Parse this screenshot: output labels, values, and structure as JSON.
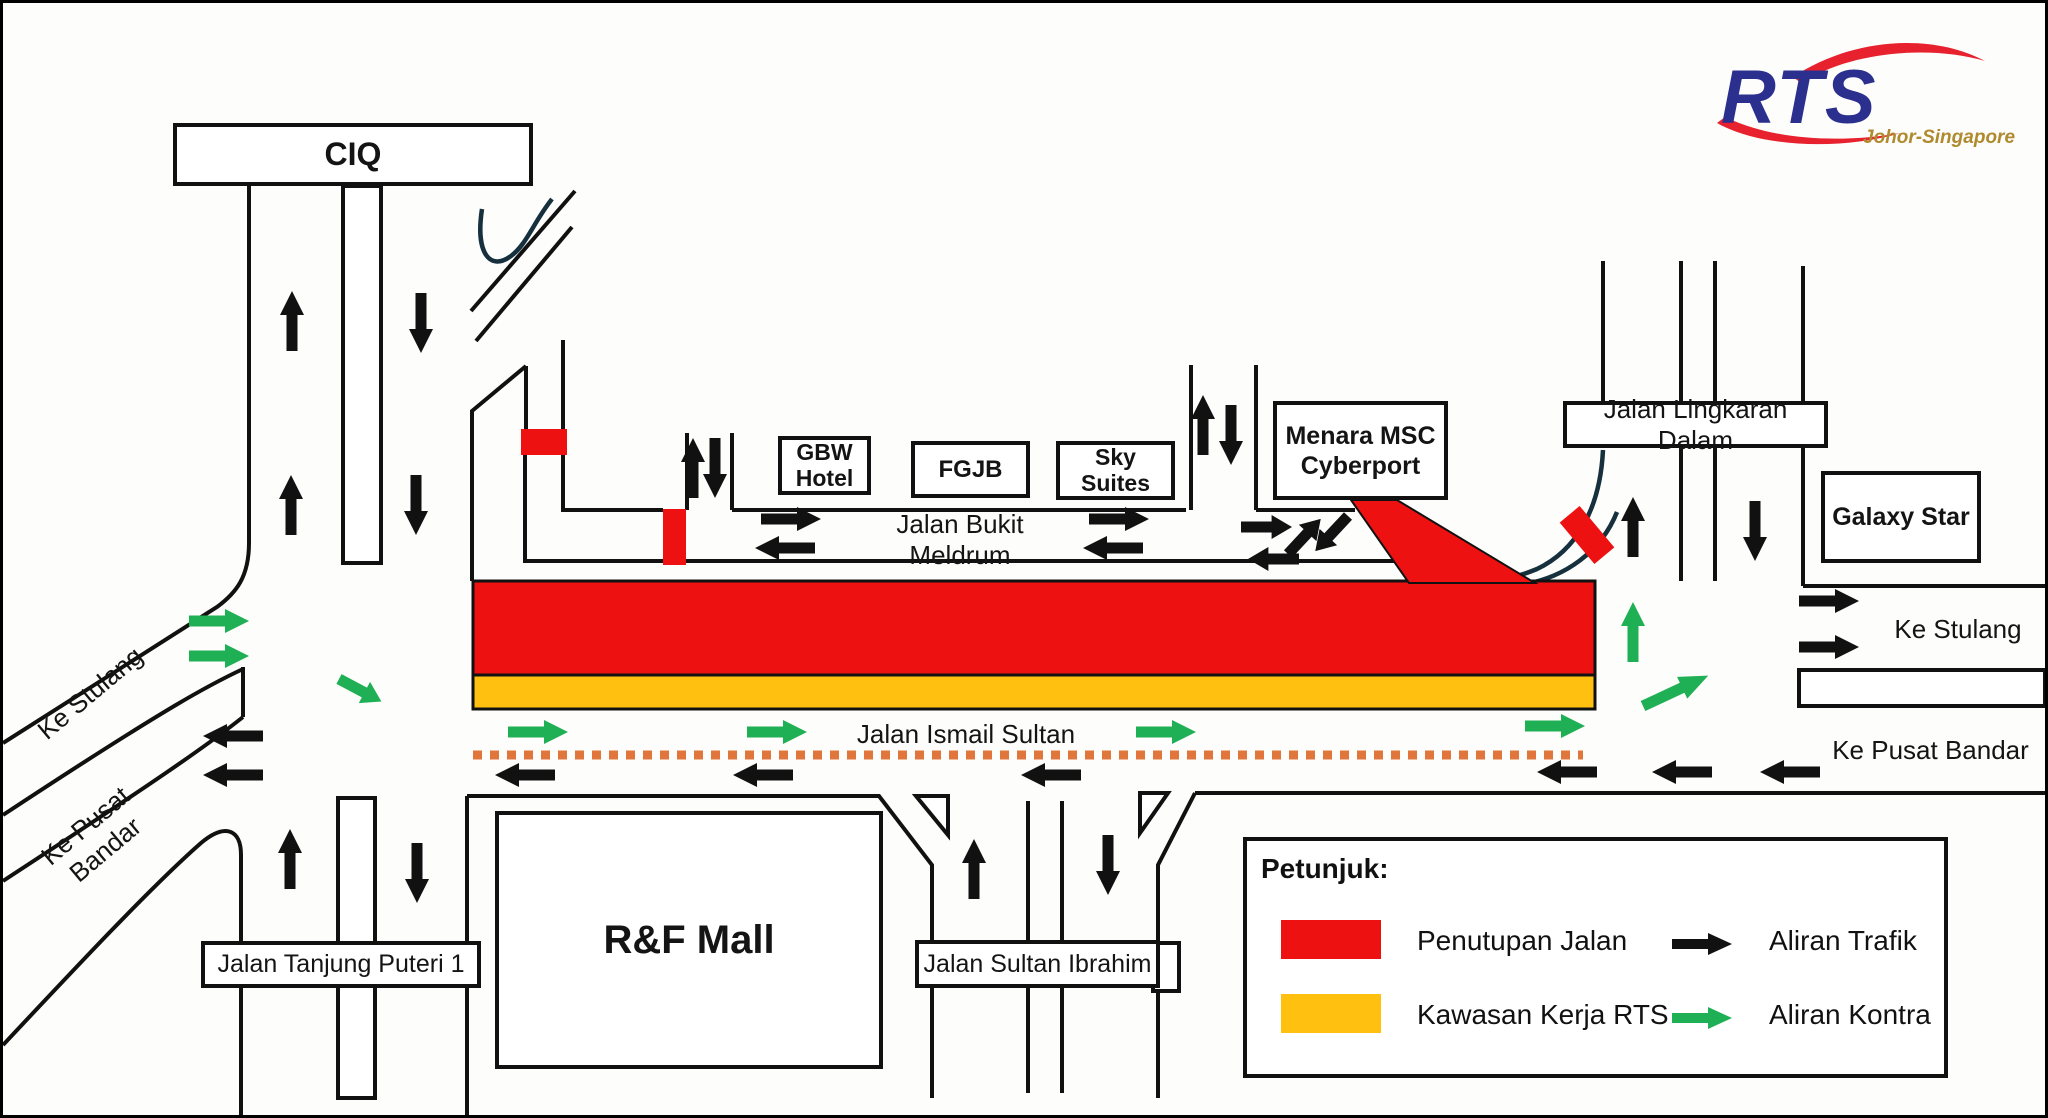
{
  "title": "RTS Johor-Singapore road closure diagram",
  "logo": {
    "brand": "RTS",
    "subtitle": "Johor-Singapore"
  },
  "landmarks": {
    "ciq": "CIQ",
    "gbw_hotel": "GBW\nHotel",
    "fgjb": "FGJB",
    "sky_suites": "Sky\nSuites",
    "menara_msc": "Menara MSC\nCyberport",
    "galaxy_star": "Galaxy Star",
    "rf_mall": "R&F Mall"
  },
  "road_labels": {
    "bukit_meldrum": "Jalan Bukit Meldrum",
    "ismail_sultan": "Jalan Ismail Sultan",
    "lingkaran_dalam": "Jalan Lingkaran Dalam",
    "sultan_ibrahim": "Jalan Sultan Ibrahim",
    "tanjung_puteri": "Jalan Tanjung Puteri 1",
    "ke_stulang_left": "Ke Stulang",
    "ke_pusat_bandar_left": "Ke Pusat Bandar",
    "ke_stulang_right": "Ke Stulang",
    "ke_pusat_bandar_right": "Ke Pusat Bandar"
  },
  "legend": {
    "title": "Petunjuk:",
    "closure_label": "Penutupan Jalan",
    "work_area_label": "Kawasan Kerja RTS",
    "traffic_flow_label": "Aliran Trafik",
    "contra_flow_label": "Aliran Kontra"
  },
  "colors": {
    "closure_red": "#EE1111",
    "work_yellow": "#FFC010",
    "traffic_black": "#111111",
    "contra_green": "#1FAF54",
    "dotted_orange": "#E0763C",
    "curve_dark": "#16303E",
    "logo_navy": "#2B2F8E",
    "logo_red": "#E8212E",
    "logo_gold": "#B08A2E"
  }
}
